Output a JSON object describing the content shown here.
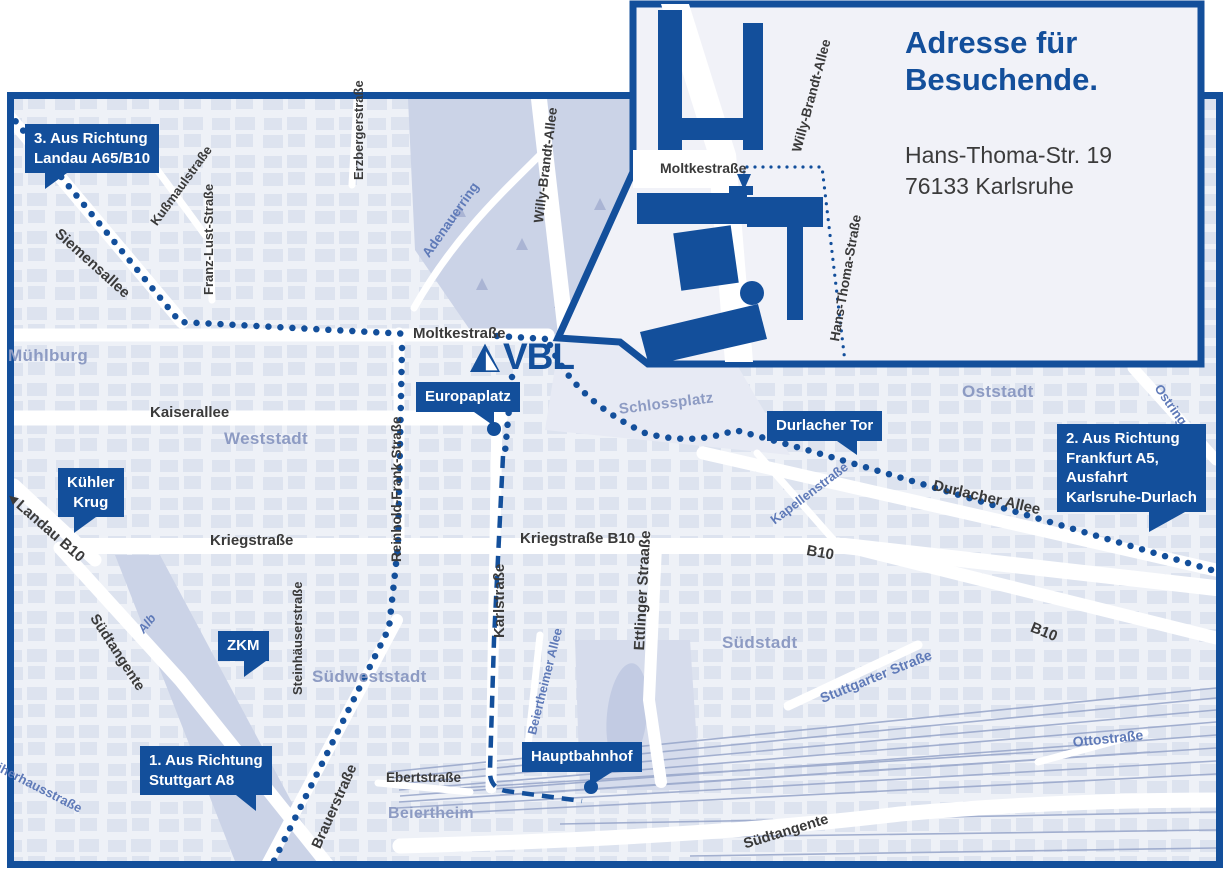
{
  "colors": {
    "brand": "#134F9B",
    "map_background": "#EEF1F7",
    "building_block": "#DAE0EE",
    "park": "#CBD3E7",
    "railway": "#9AA8CB",
    "street_label": "#3A3A3A",
    "street_label_blue": "#5F7AB8",
    "area_label": "#8D9BC3"
  },
  "logo": {
    "text": "VBL"
  },
  "callouts": {
    "landau": "3. Aus Richtung\nLandau A65/B10",
    "kuehler_krug": "Kühler\nKrug",
    "zkm": "ZKM",
    "stuttgart": "1. Aus Richtung\nStuttgart A8",
    "europaplatz": "Europaplatz",
    "durlacher_tor": "Durlacher Tor",
    "frankfurt": "2. Aus Richtung\nFrankfurt A5,\nAusfahrt\nKarlsruhe-Durlach",
    "hauptbahnhof": "Hauptbahnhof"
  },
  "inset": {
    "title": "Adresse für\nBesuchende.",
    "address": "Hans-Thoma-Str. 19\n76133 Karlsruhe",
    "streets": {
      "moltkestrasse": "Moltkestraße",
      "willy_brandt_allee": "Willy-Brandt-Allee",
      "hans_thoma_strasse": "Hans-Thoma-Straße"
    }
  },
  "streets": {
    "siemensallee": "Siemensallee",
    "kussmaulstrasse": "Kußmaulstraße",
    "franz_lust_strasse": "Franz-Lust-Straße",
    "erzbergerstrasse": "Erzbergerstraße",
    "moltkestrasse": "Moltkestraße",
    "adenauerring": "Adenauerring",
    "willy_brandt_allee": "Willy-Brandt-Allee",
    "kaiserallee": "Kaiserallee",
    "reinhold_frank_strasse": "Reinhold-Frank-Straße",
    "landau_b10": "◄Landau B10",
    "kriegstrasse": "Kriegstraße",
    "kriegstrasse_b10": "Kriegstraße B10",
    "karlstrasse": "Karlstraße",
    "steinhaeuserstrasse": "Steinhäuserstraße",
    "alb": "Alb",
    "suedtangente_west": "Südtangente",
    "suedtangente_sued": "Südtangente",
    "weiherhausstrasse": "Weiherhausstraße",
    "brauerstrasse": "Brauerstraße",
    "ebertstrasse": "Ebertstraße",
    "beiertheimer_allee": "Beiertheimer Allee",
    "ettlinger_strasse": "Ettlinger Straaße",
    "kapellenstrasse": "Kapellenstraße",
    "durlacher_allee": "Durlacher Allee",
    "b10_mitte": "B10",
    "b10_ost": "B10",
    "stuttgarter_strasse": "Stuttgarter Straße",
    "ottostrasse": "Ottostraße",
    "ostring": "Ostring"
  },
  "areas": {
    "muehlburg": "Mühlburg",
    "weststadt": "Weststadt",
    "suedweststadt": "Südweststadt",
    "suedstadt": "Südstadt",
    "oststadt": "Oststadt",
    "beiertheim": "Beiertheim",
    "schlossplatz": "Schlossplatz"
  }
}
